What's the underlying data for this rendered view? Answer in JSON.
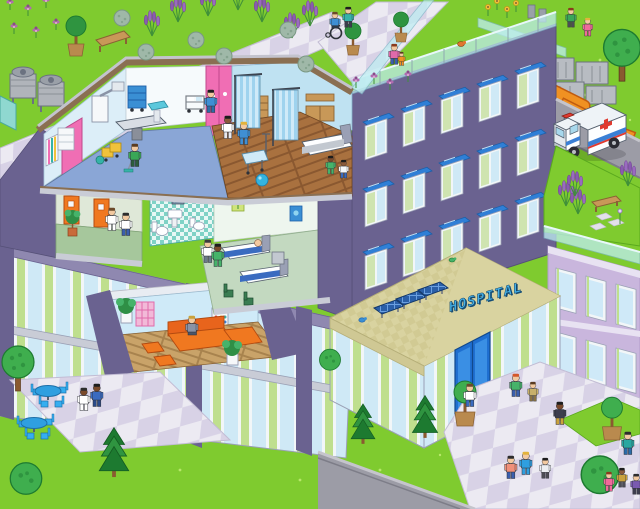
{
  "scene": {
    "type": "isometric-pixel-art-illustration",
    "subject": "hospital cutaway building with rooftop gardens, ambulance and grounds",
    "sign": {
      "text": "HOSPITAL"
    },
    "palette": {
      "grass": "#7fcb2f",
      "grass_dark": "#5aa81e",
      "building_purple": "#6a6290",
      "building_trim": "#8f88b0",
      "lilac_wall": "#c9b6dd",
      "glass_blue": "#cfe9f6",
      "glass_green": "#bfdf8e",
      "window_awning_blue": "#2f7fd6",
      "roof_tan": "#d9d3a0",
      "fascia_brown": "#8a6f52",
      "slab_gray": "#c9ccd6",
      "path_tile_light": "#eceaf2",
      "path_tile_dark": "#d8d2e6",
      "road_gray": "#9c9ca6",
      "or_floor_blue": "#8aa6d6",
      "ward_wood": "#a9713f",
      "lounge_wood": "#c9a369",
      "corridor_green": "#a6c79c",
      "bathroom_teal": "#7fd2c6",
      "accent_pink": "#f06eb4",
      "accent_orange": "#f07820",
      "curtain_blue": "#9fd3ee",
      "ambulance_stripe": "#3a7fd5",
      "cross_red": "#e03a2f",
      "railing_glass": "#bfeef2",
      "solar_blue": "#2a5fa8",
      "table_blue": "#2f9fe0",
      "sign_blue": "#45b1e8"
    },
    "rooms": [
      {
        "id": "operating-room",
        "items": [
          "operating-table",
          "surgical-machine",
          "supply-cart",
          "sink",
          "pink-doors",
          "doctor",
          "nurse",
          "cleaner-with-mop",
          "cleaning-cart"
        ]
      },
      {
        "id": "maternity-ward",
        "items": [
          "privacy-curtains",
          "hospital-bed",
          "bassinet",
          "wood-cabinets",
          "iv-pole",
          "exercise-ball",
          "children"
        ]
      },
      {
        "id": "corridor",
        "items": [
          "orange-doors",
          "nurse-with-clipboard",
          "visitor",
          "potted-plant"
        ]
      },
      {
        "id": "bathroom",
        "items": [
          "mirror",
          "sink",
          "toilet"
        ]
      },
      {
        "id": "patient-room",
        "items": [
          "two-hospital-beds",
          "patient",
          "doctor",
          "visitor-with-ball",
          "wall-pictures",
          "chairs"
        ]
      },
      {
        "id": "lounge",
        "items": [
          "orange-sofa",
          "ottomans",
          "seated-person",
          "potted-plants",
          "wall-art"
        ]
      }
    ],
    "exterior": [
      "rooftop-garden",
      "glass-railings",
      "hvac-units",
      "orange-ducts",
      "solar-panels",
      "ambulance",
      "entrance-door",
      "entrance-plaza",
      "patio-tables",
      "trees",
      "lavender",
      "roads",
      "benches",
      "birds"
    ],
    "windows": {
      "facade": [
        {
          "x": 365,
          "y": 126
        },
        {
          "x": 403,
          "y": 113
        },
        {
          "x": 441,
          "y": 100
        },
        {
          "x": 479,
          "y": 88
        },
        {
          "x": 517,
          "y": 75
        },
        {
          "x": 365,
          "y": 193
        },
        {
          "x": 403,
          "y": 180
        },
        {
          "x": 441,
          "y": 167
        },
        {
          "x": 479,
          "y": 155
        },
        {
          "x": 517,
          "y": 142
        },
        {
          "x": 365,
          "y": 256
        },
        {
          "x": 403,
          "y": 243
        },
        {
          "x": 441,
          "y": 230
        },
        {
          "x": 479,
          "y": 218
        },
        {
          "x": 517,
          "y": 205
        }
      ],
      "lilac": [
        {
          "x": 556,
          "y": 268
        },
        {
          "x": 586,
          "y": 276
        },
        {
          "x": 616,
          "y": 284
        },
        {
          "x": 556,
          "y": 332
        },
        {
          "x": 586,
          "y": 340
        },
        {
          "x": 616,
          "y": 348
        }
      ]
    },
    "people": [
      {
        "id": "or-doctor",
        "x": 222,
        "y": 116,
        "shirt": "#ffffff",
        "pants": "#e8e8ee",
        "skin": "#8a5a3b",
        "hair": "#1d1d1d"
      },
      {
        "id": "or-nurse",
        "x": 238,
        "y": 122,
        "shirt": "#3f8fd4",
        "pants": "#3f8fd4",
        "skin": "#f2c9a0",
        "hair": "#e2b33c"
      },
      {
        "id": "or-orderly",
        "x": 205,
        "y": 90,
        "shirt": "#3f8fd4",
        "pants": "#2a6ca8",
        "skin": "#f2c9a0",
        "hair": "#1d1d1d"
      },
      {
        "id": "or-cleaner",
        "x": 129,
        "y": 144,
        "shirt": "#3aa757",
        "pants": "#2c5d3a",
        "skin": "#f2c9a0",
        "hair": "#5a3b20"
      },
      {
        "id": "ward-girl",
        "x": 326,
        "y": 156,
        "s": 0.8,
        "shirt": "#46b36a",
        "pants": "#46b36a",
        "skin": "#7a4a2b",
        "hair": "#1d1d1d"
      },
      {
        "id": "ward-boy",
        "x": 339,
        "y": 160,
        "s": 0.8,
        "shirt": "#f6f8fa",
        "pants": "#3a6bc0",
        "skin": "#8a5a3b",
        "hair": "#1d1d1d"
      },
      {
        "id": "corridor-nurse",
        "x": 106,
        "y": 208,
        "shirt": "#ffffff",
        "pants": "#ffffff",
        "skin": "#f2c9a0",
        "hair": "#6b4a2a"
      },
      {
        "id": "corridor-visitor",
        "x": 120,
        "y": 213,
        "shirt": "#ffffff",
        "pants": "#3a5fae",
        "skin": "#f2c9a0",
        "hair": "#2d2d2d"
      },
      {
        "id": "pr-doctor",
        "x": 202,
        "y": 240,
        "shirt": "#ffffff",
        "pants": "#6b7b8a",
        "skin": "#f2c9a0",
        "hair": "#3d3d3d"
      },
      {
        "id": "pr-visitor",
        "x": 212,
        "y": 244,
        "shirt": "#46b36a",
        "pants": "#46b36a",
        "skin": "#7a4a2b",
        "hair": "#1d1d1d"
      },
      {
        "id": "lounge-reader",
        "x": 186,
        "y": 316,
        "seated": true,
        "shirt": "#8a93a6",
        "pants": "#4a5568",
        "skin": "#f2c9a0",
        "hair": "#caa23c"
      },
      {
        "id": "wheelchair-user",
        "x": 330,
        "y": 12,
        "s": 0.85,
        "seated": true,
        "shirt": "#3f8fd4",
        "pants": "#2d3a4a",
        "skin": "#f2c9a0",
        "hair": "#6b4a2a"
      },
      {
        "id": "wheelchair-companion",
        "x": 343,
        "y": 7,
        "s": 0.9,
        "shirt": "#36b3a8",
        "pants": "#3d3d4d",
        "skin": "#f2c9a0",
        "hair": "#1d1d1d"
      },
      {
        "id": "roof-mom",
        "x": 389,
        "y": 44,
        "s": 0.9,
        "shirt": "#e06aaa",
        "pants": "#3a5fae",
        "skin": "#f2c9a0",
        "hair": "#8a3b1d"
      },
      {
        "id": "roof-child",
        "x": 398,
        "y": 52,
        "s": 0.6,
        "shirt": "#f09122",
        "pants": "#f09122",
        "skin": "#f2c9a0",
        "hair": "#5a3b20"
      },
      {
        "id": "playing-boy",
        "x": 566,
        "y": 8,
        "s": 0.85,
        "shirt": "#3aa757",
        "pants": "#4d4d55",
        "skin": "#f2c9a0",
        "hair": "#8a3b1d"
      },
      {
        "id": "playing-girl",
        "x": 583,
        "y": 18,
        "s": 0.8,
        "shirt": "#f06a9a",
        "pants": "#f06a9a",
        "skin": "#f2c9a0",
        "hair": "#e2b33c"
      },
      {
        "id": "entrance-visitor",
        "x": 464,
        "y": 384,
        "shirt": "#ffffff",
        "pants": "#3a6bc0",
        "skin": "#f2c9a0",
        "hair": "#6b4a2a"
      },
      {
        "id": "plaza-mom",
        "x": 510,
        "y": 374,
        "shirt": "#46b36a",
        "pants": "#3a5fae",
        "skin": "#f2c9a0",
        "hair": "#d4572a"
      },
      {
        "id": "plaza-scout",
        "x": 528,
        "y": 382,
        "s": 0.85,
        "shirt": "#c8b06a",
        "pants": "#8a7342",
        "skin": "#f2c9a0",
        "hair": "#5a3b20"
      },
      {
        "id": "plaza-worker",
        "x": 554,
        "y": 402,
        "shirt": "#3d3d4d",
        "pants": "#caa23c",
        "skin": "#7a4a2b",
        "hair": "#1d1d1d"
      },
      {
        "id": "plaza-man",
        "x": 505,
        "y": 456,
        "shirt": "#f0907a",
        "pants": "#3a5fae",
        "skin": "#f2c9a0",
        "hair": "#2d2d2d"
      },
      {
        "id": "plaza-woman",
        "x": 520,
        "y": 452,
        "shirt": "#2f9fe0",
        "pants": "#2f9fe0",
        "skin": "#f2c9a0",
        "hair": "#e2b33c"
      },
      {
        "id": "plaza-kid",
        "x": 540,
        "y": 458,
        "s": 0.9,
        "shirt": "#eceef2",
        "pants": "#4d4d55",
        "skin": "#f2c9a0",
        "hair": "#1d1d1d"
      },
      {
        "id": "plaza-visitor-teal",
        "x": 622,
        "y": 432,
        "shirt": "#2aa7a0",
        "pants": "#2a6ca8",
        "skin": "#f2c9a0",
        "hair": "#2d2d2d"
      },
      {
        "id": "corner-girl",
        "x": 604,
        "y": 472,
        "s": 0.85,
        "shirt": "#f06a9a",
        "pants": "#f06a9a",
        "skin": "#f2c9a0",
        "hair": "#8a3b1d"
      },
      {
        "id": "corner-boy",
        "x": 617,
        "y": 468,
        "s": 0.85,
        "shirt": "#caa23c",
        "pants": "#4d4d55",
        "skin": "#8a5a3b",
        "hair": "#1d1d1d"
      },
      {
        "id": "corner-man",
        "x": 631,
        "y": 474,
        "s": 0.9,
        "shirt": "#7a5ab0",
        "pants": "#3d3d4d",
        "skin": "#f2c9a0",
        "hair": "#2d2d2d"
      },
      {
        "id": "patio-elder",
        "x": 78,
        "y": 388,
        "shirt": "#ffffff",
        "pants": "#ffffff",
        "skin": "#7a4a2b",
        "hair": "#2d2d2d"
      },
      {
        "id": "patio-walker",
        "x": 91,
        "y": 384,
        "shirt": "#3a6bc0",
        "pants": "#2a4a8a",
        "skin": "#7a4a2b",
        "hair": "#1d1d1d"
      }
    ],
    "trees": [
      {
        "x": 76,
        "y": 56,
        "type": "potted"
      },
      {
        "x": 353,
        "y": 55,
        "type": "potted",
        "s": 0.8
      },
      {
        "x": 401,
        "y": 42,
        "type": "potted",
        "s": 0.75
      },
      {
        "x": 622,
        "y": 80,
        "type": "round",
        "s": 1.15
      },
      {
        "x": 18,
        "y": 390,
        "type": "round",
        "s": 1.0
      },
      {
        "x": 114,
        "y": 476,
        "type": "conifer",
        "s": 1.05
      },
      {
        "x": 363,
        "y": 443,
        "type": "conifer",
        "s": 0.85
      },
      {
        "x": 425,
        "y": 437,
        "type": "conifer",
        "s": 0.9
      },
      {
        "x": 465,
        "y": 426,
        "type": "planter"
      },
      {
        "x": 612,
        "y": 440,
        "type": "planter",
        "s": 0.95
      },
      {
        "x": 600,
        "y": 486,
        "type": "bush",
        "s": 1.25
      },
      {
        "x": 26,
        "y": 488,
        "type": "bush",
        "s": 1.05
      },
      {
        "x": 330,
        "y": 366,
        "type": "bush",
        "s": 0.7
      }
    ],
    "plants": [
      {
        "x": 10,
        "y": 10,
        "type": "flower"
      },
      {
        "x": 28,
        "y": 16,
        "type": "flower"
      },
      {
        "x": 46,
        "y": 8,
        "type": "flower"
      },
      {
        "x": 14,
        "y": 34,
        "type": "flower"
      },
      {
        "x": 36,
        "y": 38,
        "type": "flower"
      },
      {
        "x": 56,
        "y": 30,
        "type": "flower"
      },
      {
        "x": 356,
        "y": 88,
        "type": "flower"
      },
      {
        "x": 374,
        "y": 84,
        "type": "flower"
      },
      {
        "x": 390,
        "y": 90,
        "type": "flower"
      },
      {
        "x": 408,
        "y": 82,
        "type": "flower"
      },
      {
        "x": 152,
        "y": 36,
        "type": "lavender"
      },
      {
        "x": 178,
        "y": 22,
        "type": "lavender"
      },
      {
        "x": 208,
        "y": 16,
        "type": "lavender"
      },
      {
        "x": 238,
        "y": 10,
        "type": "lavender"
      },
      {
        "x": 262,
        "y": 22,
        "type": "lavender"
      },
      {
        "x": 292,
        "y": 38,
        "type": "lavender"
      },
      {
        "x": 310,
        "y": 26,
        "type": "lavender"
      },
      {
        "x": 566,
        "y": 206,
        "type": "lavender"
      },
      {
        "x": 578,
        "y": 214,
        "type": "lavender"
      },
      {
        "x": 575,
        "y": 196,
        "type": "lavender"
      },
      {
        "x": 628,
        "y": 186,
        "type": "lavender"
      },
      {
        "x": 146,
        "y": 52,
        "type": "ballbush"
      },
      {
        "x": 196,
        "y": 40,
        "type": "ballbush"
      },
      {
        "x": 224,
        "y": 56,
        "type": "ballbush"
      },
      {
        "x": 288,
        "y": 30,
        "type": "ballbush"
      },
      {
        "x": 306,
        "y": 64,
        "type": "ballbush"
      },
      {
        "x": 122,
        "y": 18,
        "type": "ballbush"
      },
      {
        "x": 488,
        "y": 16,
        "type": "sunflower"
      },
      {
        "x": 497,
        "y": 10,
        "type": "sunflower"
      },
      {
        "x": 507,
        "y": 18,
        "type": "sunflower"
      },
      {
        "x": 516,
        "y": 12,
        "type": "sunflower"
      },
      {
        "x": 620,
        "y": 224,
        "type": "iris"
      }
    ],
    "tables": [
      {
        "x": 48,
        "y": 392
      },
      {
        "x": 34,
        "y": 424
      }
    ]
  }
}
